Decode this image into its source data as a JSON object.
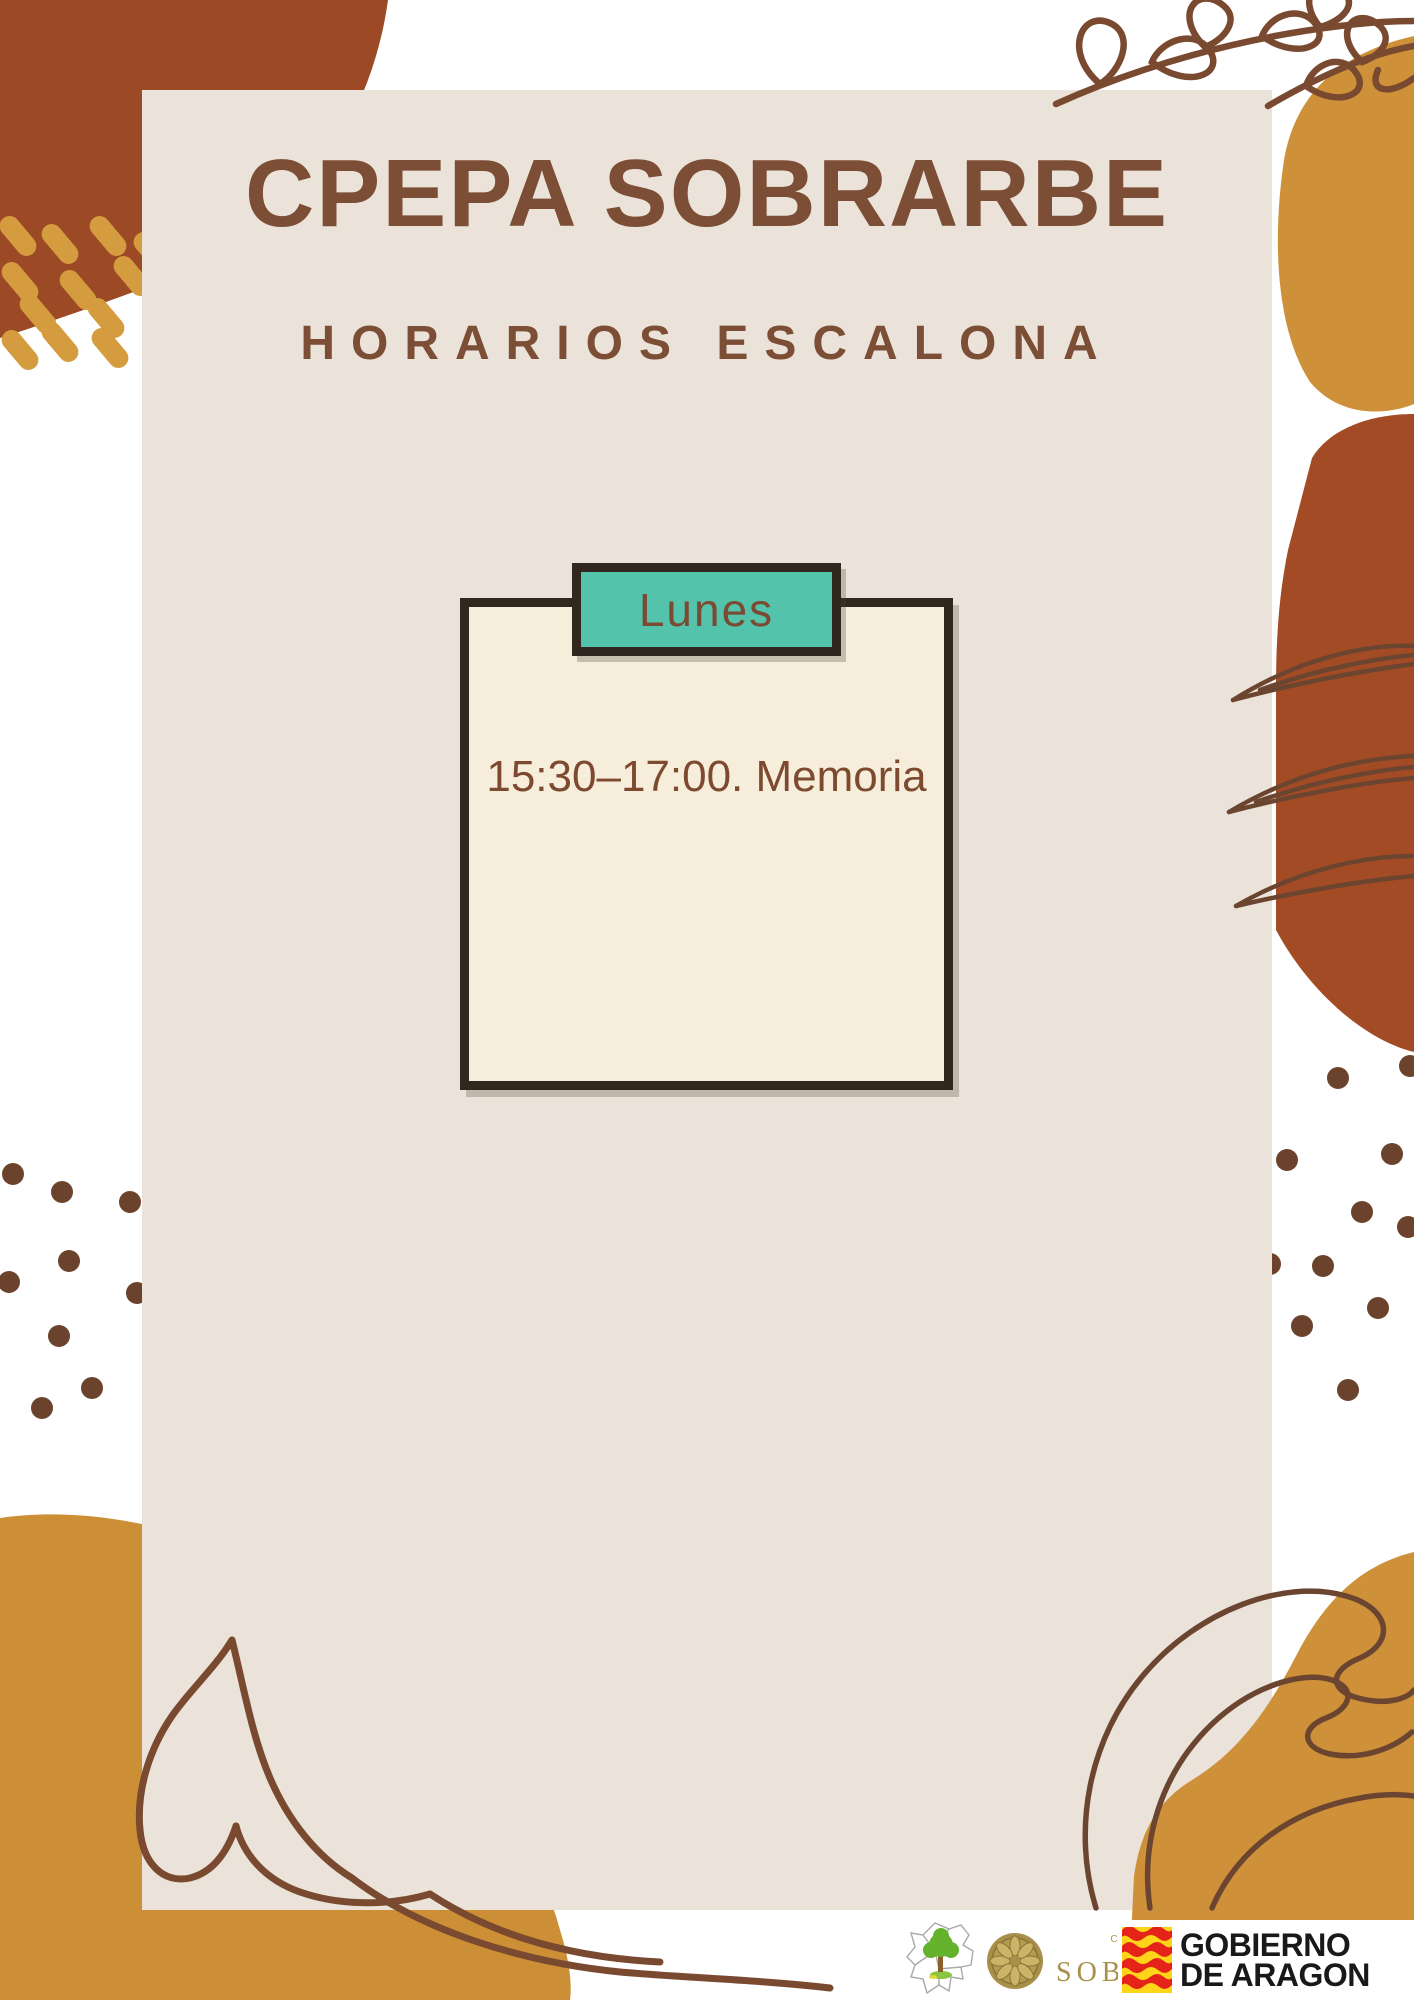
{
  "poster": {
    "title": "CPEPA SOBRARBE",
    "subtitle": "HORARIOS ESCALONA",
    "card": {
      "tab_label": "Lunes",
      "schedule_line": "15:30–17:00. Memoria"
    },
    "footer": {
      "sobrarbe": {
        "comarca": "COMARCA",
        "de": "DE",
        "name": "SOBRARBE"
      },
      "gobierno": {
        "line1": "GOBIERNO",
        "line2": "DE ARAGON"
      }
    },
    "colors": {
      "background": "#ffffff",
      "panel_beige": "#ebe3da",
      "card_cream": "#f6eedb",
      "tab_teal": "#54c3ac",
      "outline_dark": "#31271f",
      "text_brown": "#7c4e35",
      "rust": "#9c4a26",
      "gold": "#ce9038",
      "dash_gold": "#d49c3f",
      "dot_brown": "#6b432c",
      "doodle_brown": "#7a4a30",
      "flag_red": "#e5231b",
      "flag_yellow": "#ffd617"
    }
  }
}
